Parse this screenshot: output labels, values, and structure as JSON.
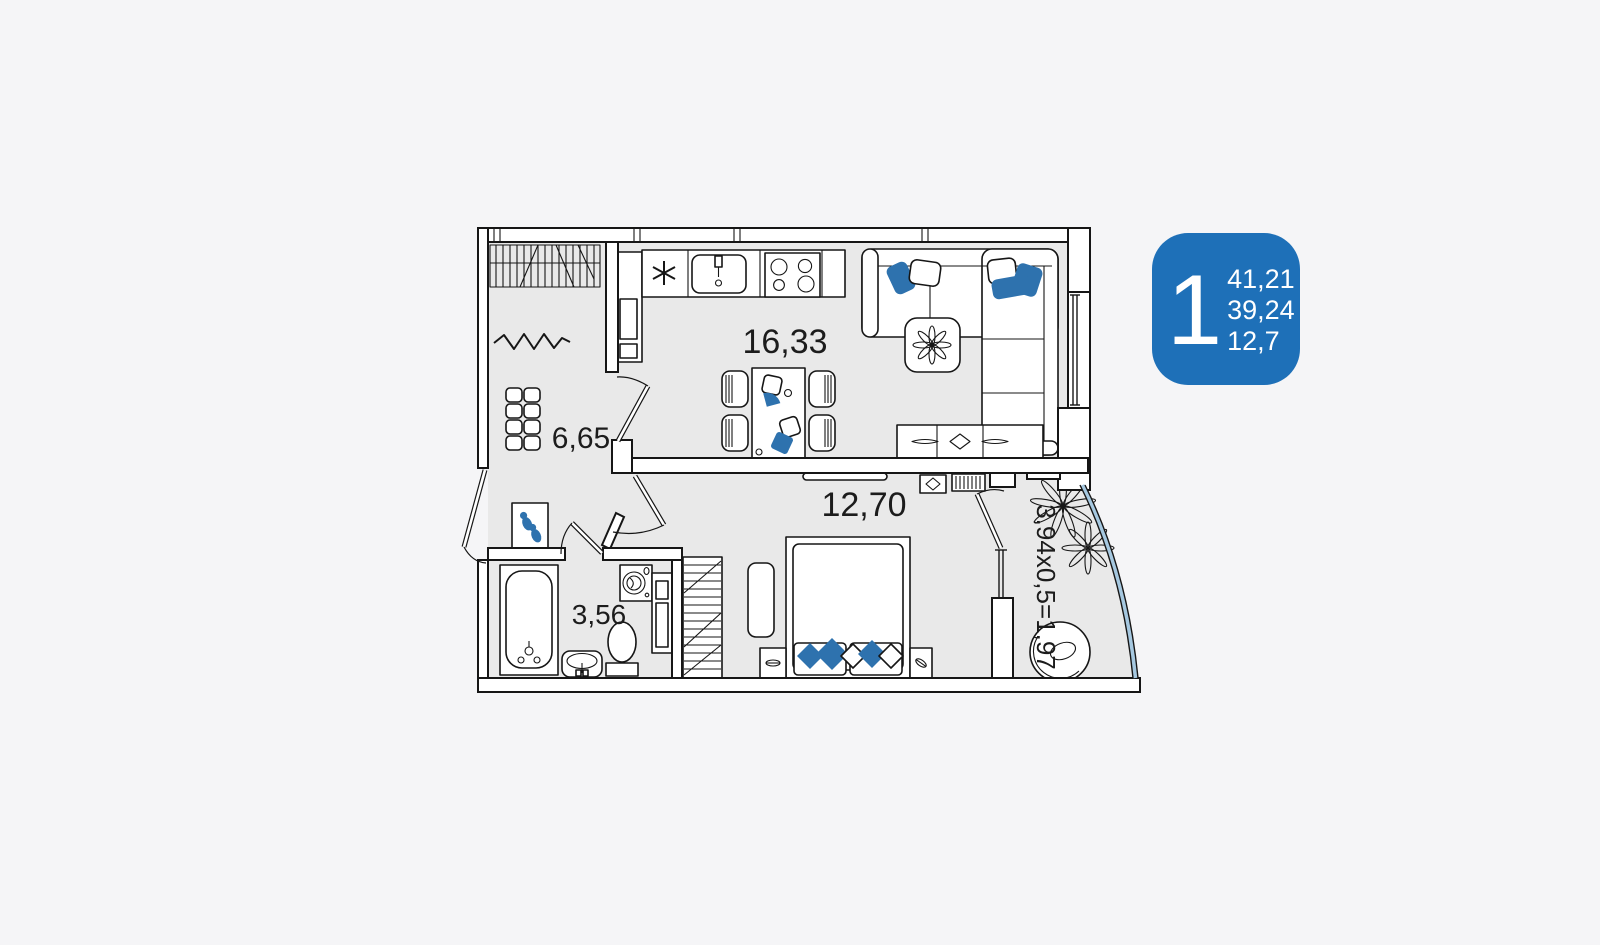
{
  "theme": {
    "page-bg": "#f5f5f7",
    "floor": "#e9e9e9",
    "wall": "#161616",
    "ink": "#1c1c1c",
    "accent": "#2e72ae",
    "glass": "#a6c8e0",
    "badge": "#1e70b8",
    "badge-ink": "#ffffff"
  },
  "badge": {
    "big": "1",
    "values": [
      "41,21",
      "39,24",
      "12,7"
    ]
  },
  "rooms": {
    "kitchen_living": {
      "label": "16,33"
    },
    "hallway": {
      "label": "6,65"
    },
    "bedroom": {
      "label": "12,70"
    },
    "bathroom": {
      "label": "3,56"
    },
    "balcony": {
      "label": "3,94x0,5=1,97"
    }
  },
  "icons": {
    "furniture": [
      "coat-rack",
      "mirror",
      "shoe-cabinet",
      "entry-rug-slippers",
      "fridge",
      "kitchen-vent",
      "kitchen-sink",
      "stove",
      "sofa",
      "coffee-table",
      "plant",
      "dining-table",
      "chair",
      "tv-stand",
      "tv",
      "dresser",
      "radiator",
      "wardrobe",
      "bed",
      "nightstand",
      "bedside-rug",
      "bathtub",
      "wash-basin",
      "toilet",
      "washing-machine",
      "bathroom-shelf",
      "egg-chair",
      "balcony-plant"
    ]
  }
}
